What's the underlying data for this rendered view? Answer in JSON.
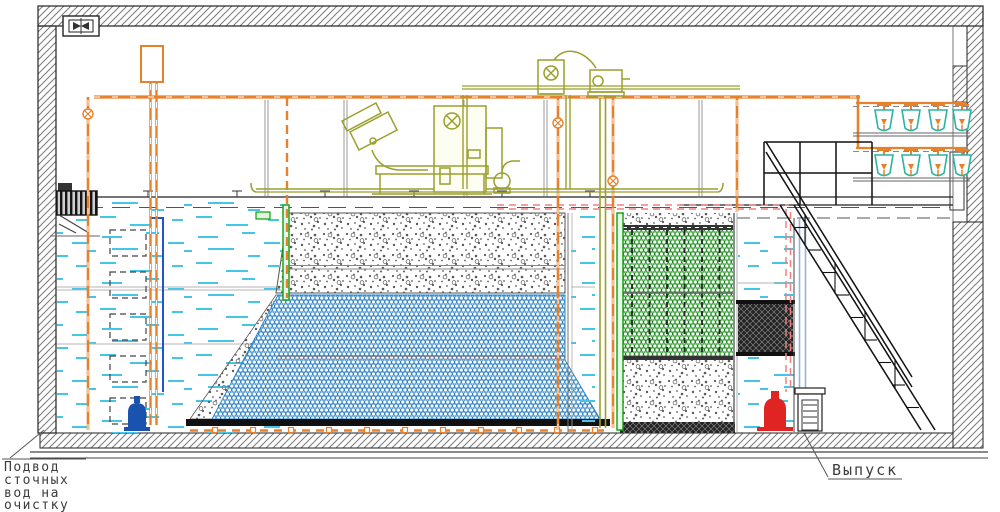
{
  "labels": {
    "inlet_line1": "Подвод",
    "inlet_line2": "сточных",
    "inlet_line3": "вод на",
    "inlet_line4": "очистку",
    "outlet": "Выпуск"
  },
  "colors": {
    "pipe_orange": "#e8812c",
    "equipment_olive": "#9aa02c",
    "water_dash_cyan": "#45c6e6",
    "media_blue": "#2e86c8",
    "media_green": "#2ca02c",
    "accent_green": "#0aa00a",
    "pump_red": "#e02424",
    "pump_blue": "#1a52b0",
    "pipe_red_dashed": "#ee8080",
    "pipe_light_blue": "#8fb6dd",
    "diffuser_teal": "#2bb3a3",
    "line_black": "#1c1c1c",
    "hatch_gray": "#7a7a7a",
    "label_text": "#3c3c3c"
  },
  "icons": {
    "fan": "fan-icon",
    "valve": "valve-icon",
    "nozzle": "aeration-nozzle-icon",
    "diffuser": "diffuser-cup-icon"
  }
}
